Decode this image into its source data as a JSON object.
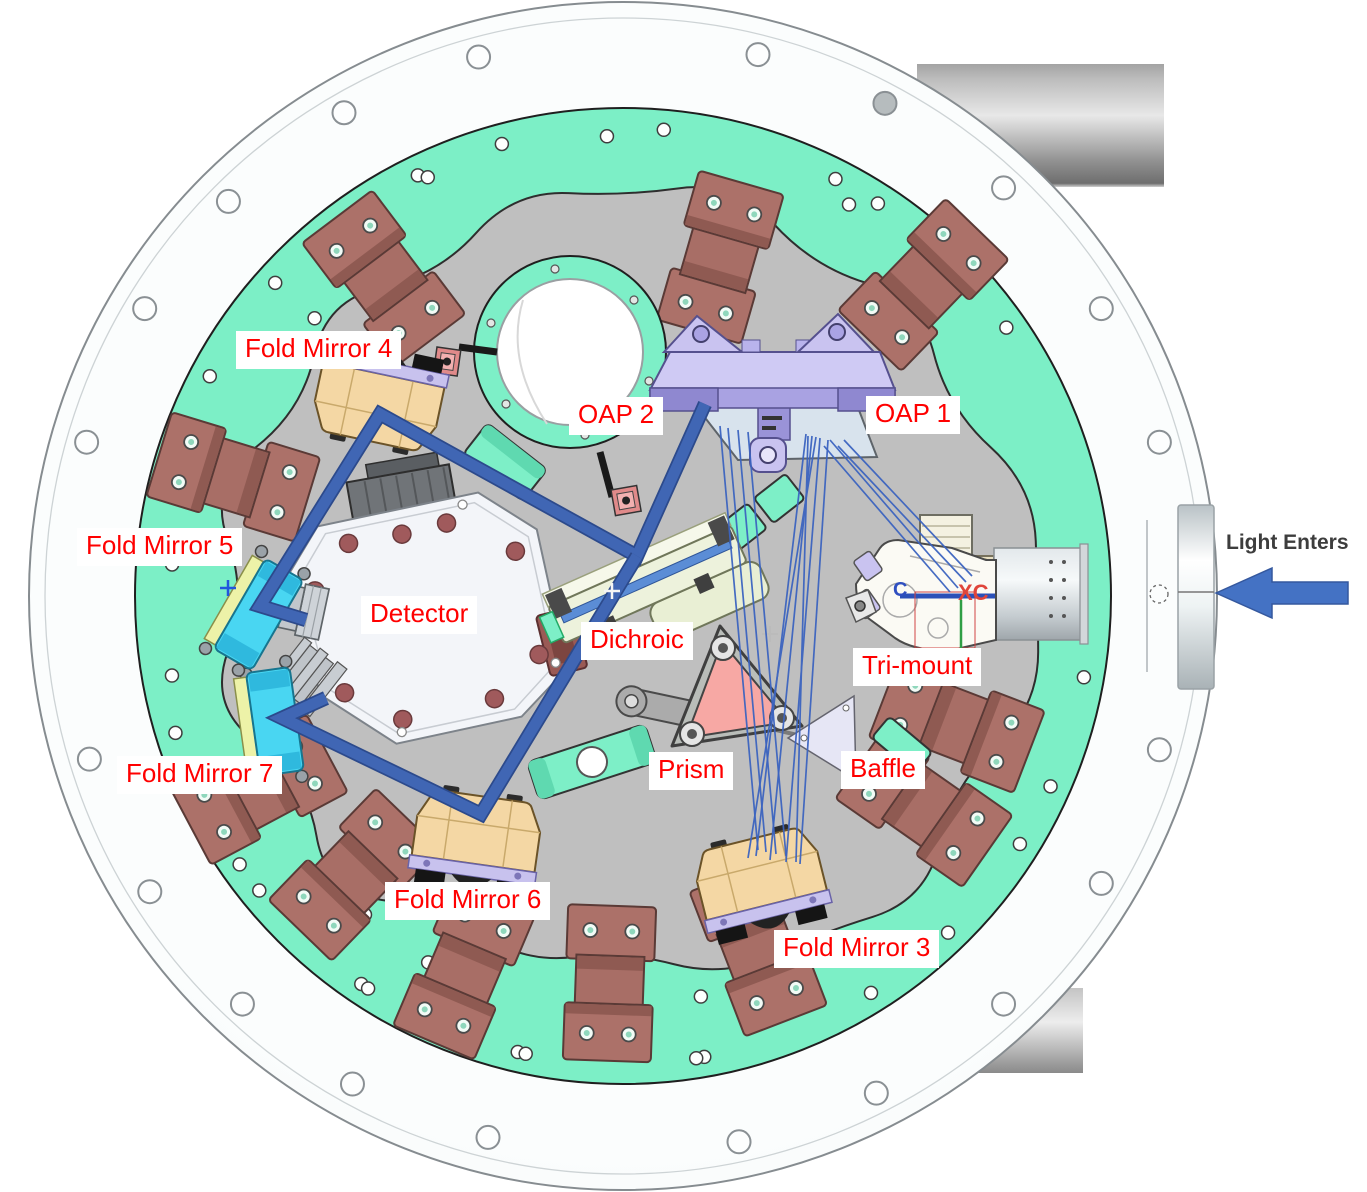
{
  "diagram_labels": {
    "fold_mirror_4": "Fold Mirror 4",
    "oap_2": "OAP 2",
    "oap_1": "OAP 1",
    "fold_mirror_5": "Fold Mirror 5",
    "detector": "Detector",
    "dichroic": "Dichroic",
    "tri_mount": "Tri-mount",
    "fold_mirror_7": "Fold Mirror 7",
    "prism": "Prism",
    "baffle": "Baffle",
    "fold_mirror_6": "Fold Mirror 6",
    "fold_mirror_3": "Fold Mirror 3"
  },
  "annotations": {
    "light_enters": "Light Enters"
  },
  "cad_labels": {
    "xc": "XC",
    "c": "C"
  },
  "colors": {
    "label_text": "#FF0000",
    "label_background": "#FFFFFF",
    "annotation_text": "#3D3D3D",
    "beam_blue": "#3B5FAE",
    "ray_blue": "#3C64C0",
    "arrow_blue": "#4472C4",
    "ring_mint": "#7CEFC6",
    "plate_gray": "#BFBFBF",
    "flange_white": "#F7FBFB",
    "clamp_maroon": "#AC7169",
    "mirror_mount_tan": "#F4D7A4",
    "mirror_mount_cyan": "#49D6F2",
    "oap_mount_lavender": "#C9C3F0",
    "prism_salmon": "#F7A8A4",
    "dichroic_pale": "#EDF2DC"
  }
}
